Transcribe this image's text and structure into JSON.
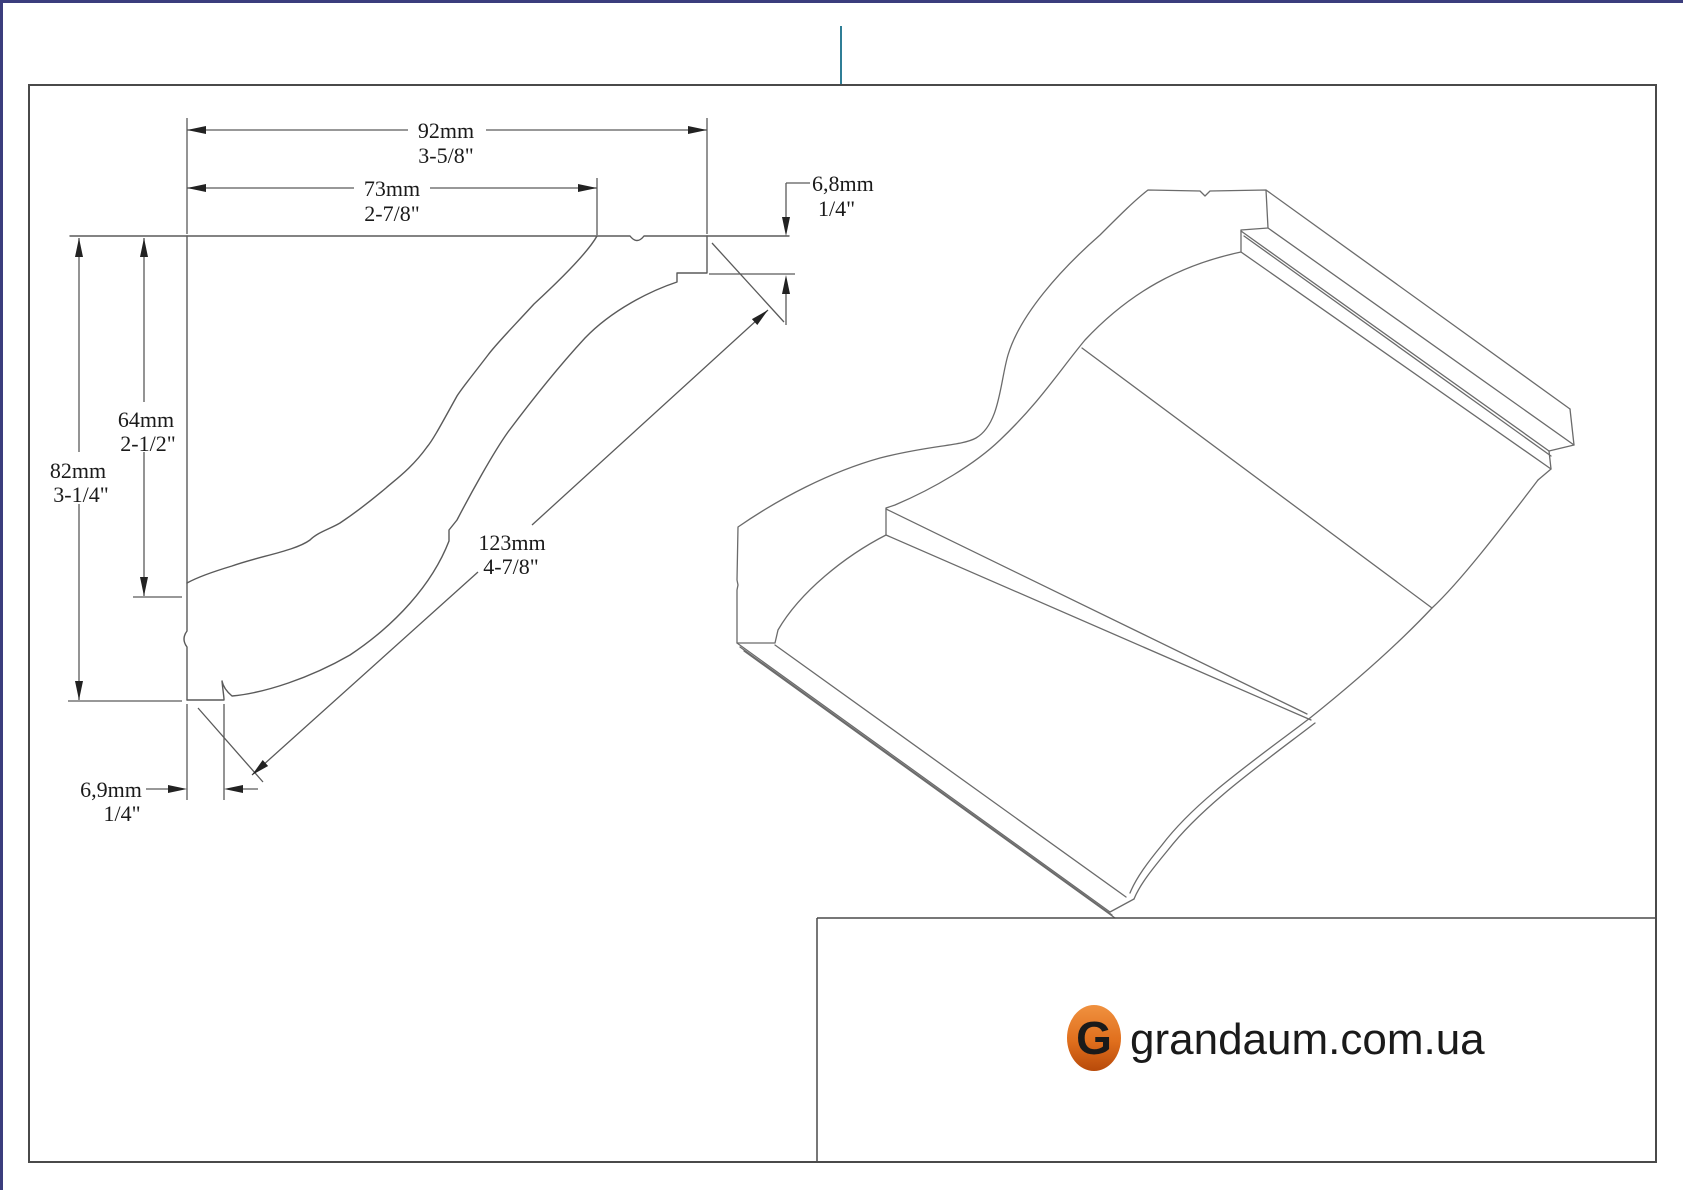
{
  "colors": {
    "frame_accent": "#3b3d7d",
    "registration_mark": "#2f7e96",
    "box_border": "#4a4a4a",
    "drawing_line": "#5a5a5a",
    "logo_orange": "#c8500f",
    "badge_orange_top": "#f0913f",
    "badge_orange_bottom": "#b84a0a"
  },
  "dimensions": {
    "width_total": {
      "mm": "92mm",
      "inch": "3-5/8\""
    },
    "width_face": {
      "mm": "73mm",
      "inch": "2-7/8\""
    },
    "height_face": {
      "mm": "64mm",
      "inch": "2-1/2\""
    },
    "height_total": {
      "mm": "82mm",
      "inch": "3-1/4\""
    },
    "diagonal_face": {
      "mm": "123mm",
      "inch": "4-7/8\""
    },
    "top_step": {
      "mm": "6,8mm",
      "inch": "1/4\""
    },
    "bottom_step": {
      "mm": "6,9mm",
      "inch": "1/4\""
    }
  },
  "logo": {
    "site": "grandaum.com.ua",
    "badge_letter": "G"
  }
}
